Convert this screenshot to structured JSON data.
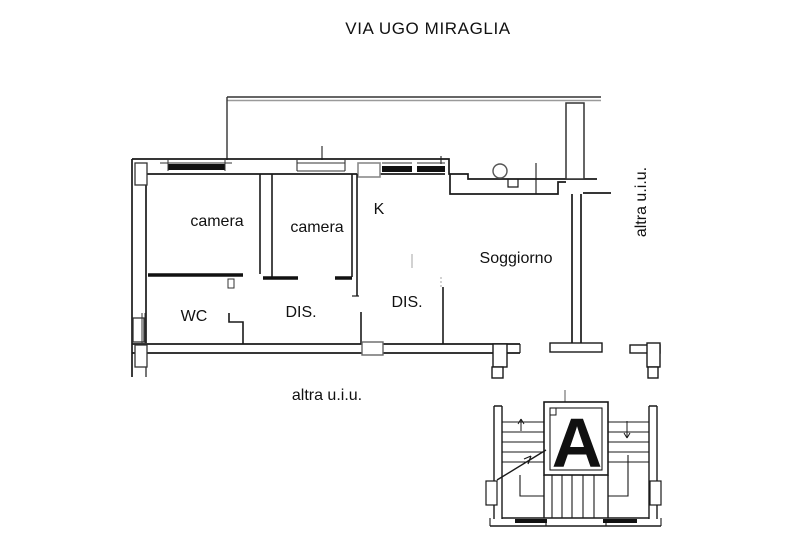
{
  "title": "VIA UGO MIRAGLIA",
  "plan": {
    "rooms": [
      {
        "id": "camera-1",
        "label": "camera"
      },
      {
        "id": "camera-2",
        "label": "camera"
      },
      {
        "id": "kitchen",
        "label": "K"
      },
      {
        "id": "soggiorno",
        "label": "Soggiorno"
      },
      {
        "id": "wc",
        "label": "WC"
      },
      {
        "id": "dis-1",
        "label": "DIS."
      },
      {
        "id": "dis-2",
        "label": "DIS."
      }
    ],
    "annotations": [
      {
        "id": "altra-uiu-right",
        "label": "altra u.i.u.",
        "rotation": -90
      },
      {
        "id": "altra-uiu-bottom",
        "label": "altra u.i.u.",
        "rotation": 0
      }
    ],
    "stairwell": {
      "label": "A"
    }
  },
  "colors": {
    "wall": "#1a1a1a",
    "thick_wall": "#111111",
    "gray": "#888888",
    "light_gray": "#b3b3b3",
    "background": "#ffffff"
  }
}
